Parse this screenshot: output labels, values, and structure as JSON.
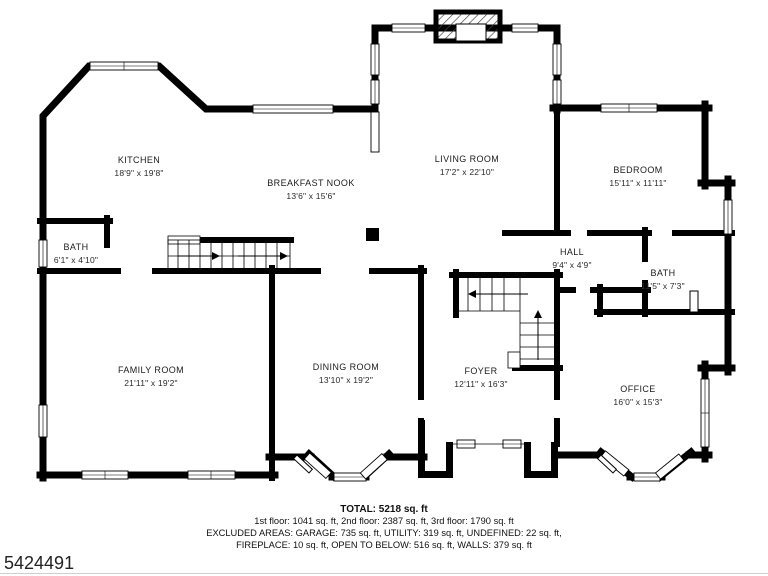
{
  "rooms": [
    {
      "id": "kitchen",
      "name": "KITCHEN",
      "dims": "18'9\" x 19'8\""
    },
    {
      "id": "breakfast-nook",
      "name": "BREAKFAST NOOK",
      "dims": "13'6\" x 15'6\""
    },
    {
      "id": "living-room",
      "name": "LIVING ROOM",
      "dims": "17'2\" x 22'10\""
    },
    {
      "id": "bedroom",
      "name": "BEDROOM",
      "dims": "15'11\" x 11'11\""
    },
    {
      "id": "bath-1",
      "name": "BATH",
      "dims": "6'1\" x 4'10\""
    },
    {
      "id": "hall",
      "name": "HALL",
      "dims": "9'4\" x 4'9\""
    },
    {
      "id": "bath-2",
      "name": "BATH",
      "dims": "11'5\" x 7'3\""
    },
    {
      "id": "family-room",
      "name": "FAMILY ROOM",
      "dims": "21'11\" x 19'2\""
    },
    {
      "id": "dining-room",
      "name": "DINING ROOM",
      "dims": "13'10\" x 19'2\""
    },
    {
      "id": "foyer",
      "name": "FOYER",
      "dims": "12'11\" x 16'3\""
    },
    {
      "id": "office",
      "name": "OFFICE",
      "dims": "16'0\" x 15'3\""
    }
  ],
  "summary": {
    "total": "TOTAL: 5218 sq. ft",
    "floors": "1st floor: 1041 sq. ft, 2nd floor: 2387 sq. ft, 3rd floor: 1790 sq. ft",
    "excluded1": "EXCLUDED AREAS: GARAGE: 735 sq. ft, UTILITY: 319 sq. ft, UNDEFINED: 22 sq. ft,",
    "excluded2": "FIREPLACE: 10 sq. ft, OPEN TO BELOW: 516 sq. ft, WALLS: 379 sq. ft"
  },
  "watermark": "5424491",
  "colors": {
    "wall": "#000000",
    "background": "#ffffff"
  }
}
